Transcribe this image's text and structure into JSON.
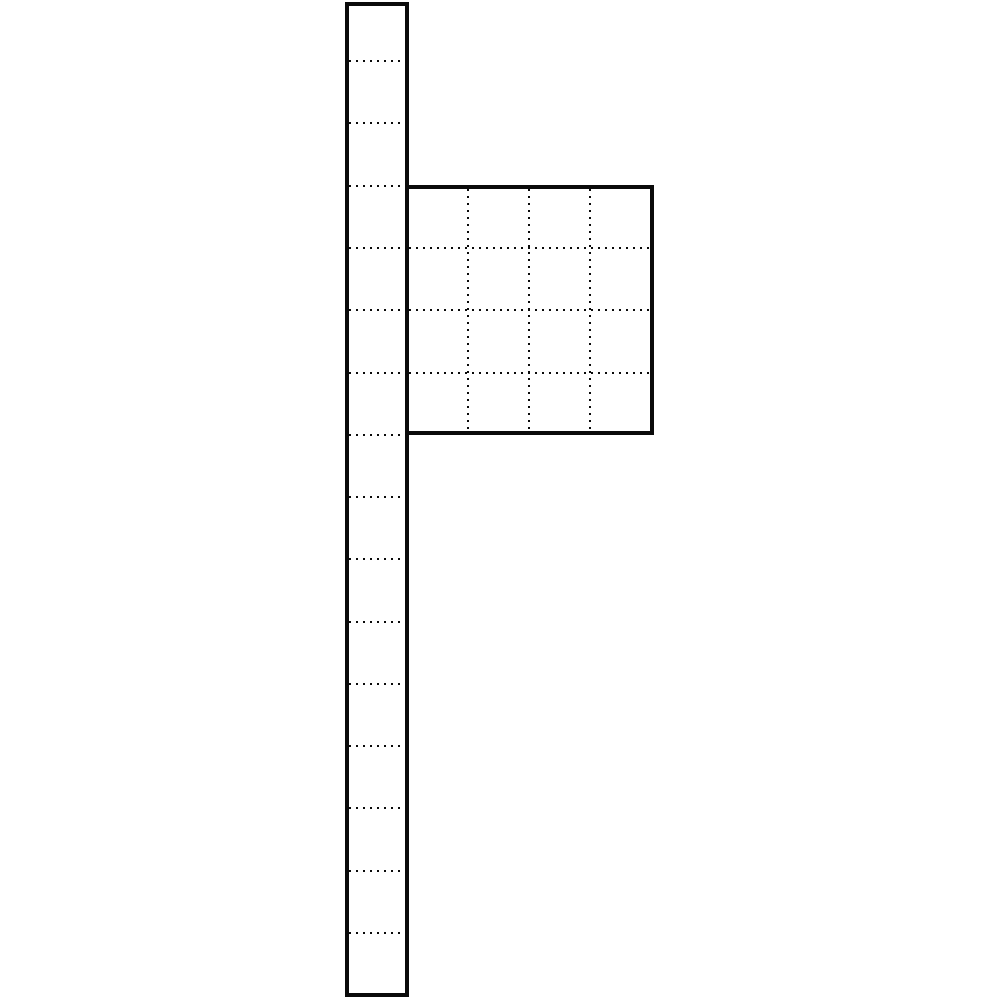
{
  "meta": {
    "figure_name": "modular-post-with-grid-panel-line-drawing",
    "background_color": "#ffffff",
    "line_color": "#0a0a0a"
  },
  "canvas": {
    "width": 1000,
    "height": 1000
  },
  "post": {
    "left": 345,
    "top": 2,
    "width": 64,
    "height": 995,
    "border_px": 4,
    "segment_count": 16,
    "divider_style": "dotted",
    "divider_ys": [
      61,
      123,
      186,
      248,
      310,
      373,
      435,
      497,
      559,
      622,
      684,
      746,
      808,
      871,
      933
    ]
  },
  "panel": {
    "left": 405,
    "top": 185,
    "width": 249,
    "height": 250,
    "border_px": 4,
    "rows": 4,
    "cols": 4,
    "divider_style": "dotted",
    "h_divider_ys": [
      248,
      310,
      373
    ],
    "v_divider_xs": [
      468,
      529,
      590
    ]
  },
  "dot_pattern": {
    "dot_px": 2,
    "gap_px": 5
  }
}
